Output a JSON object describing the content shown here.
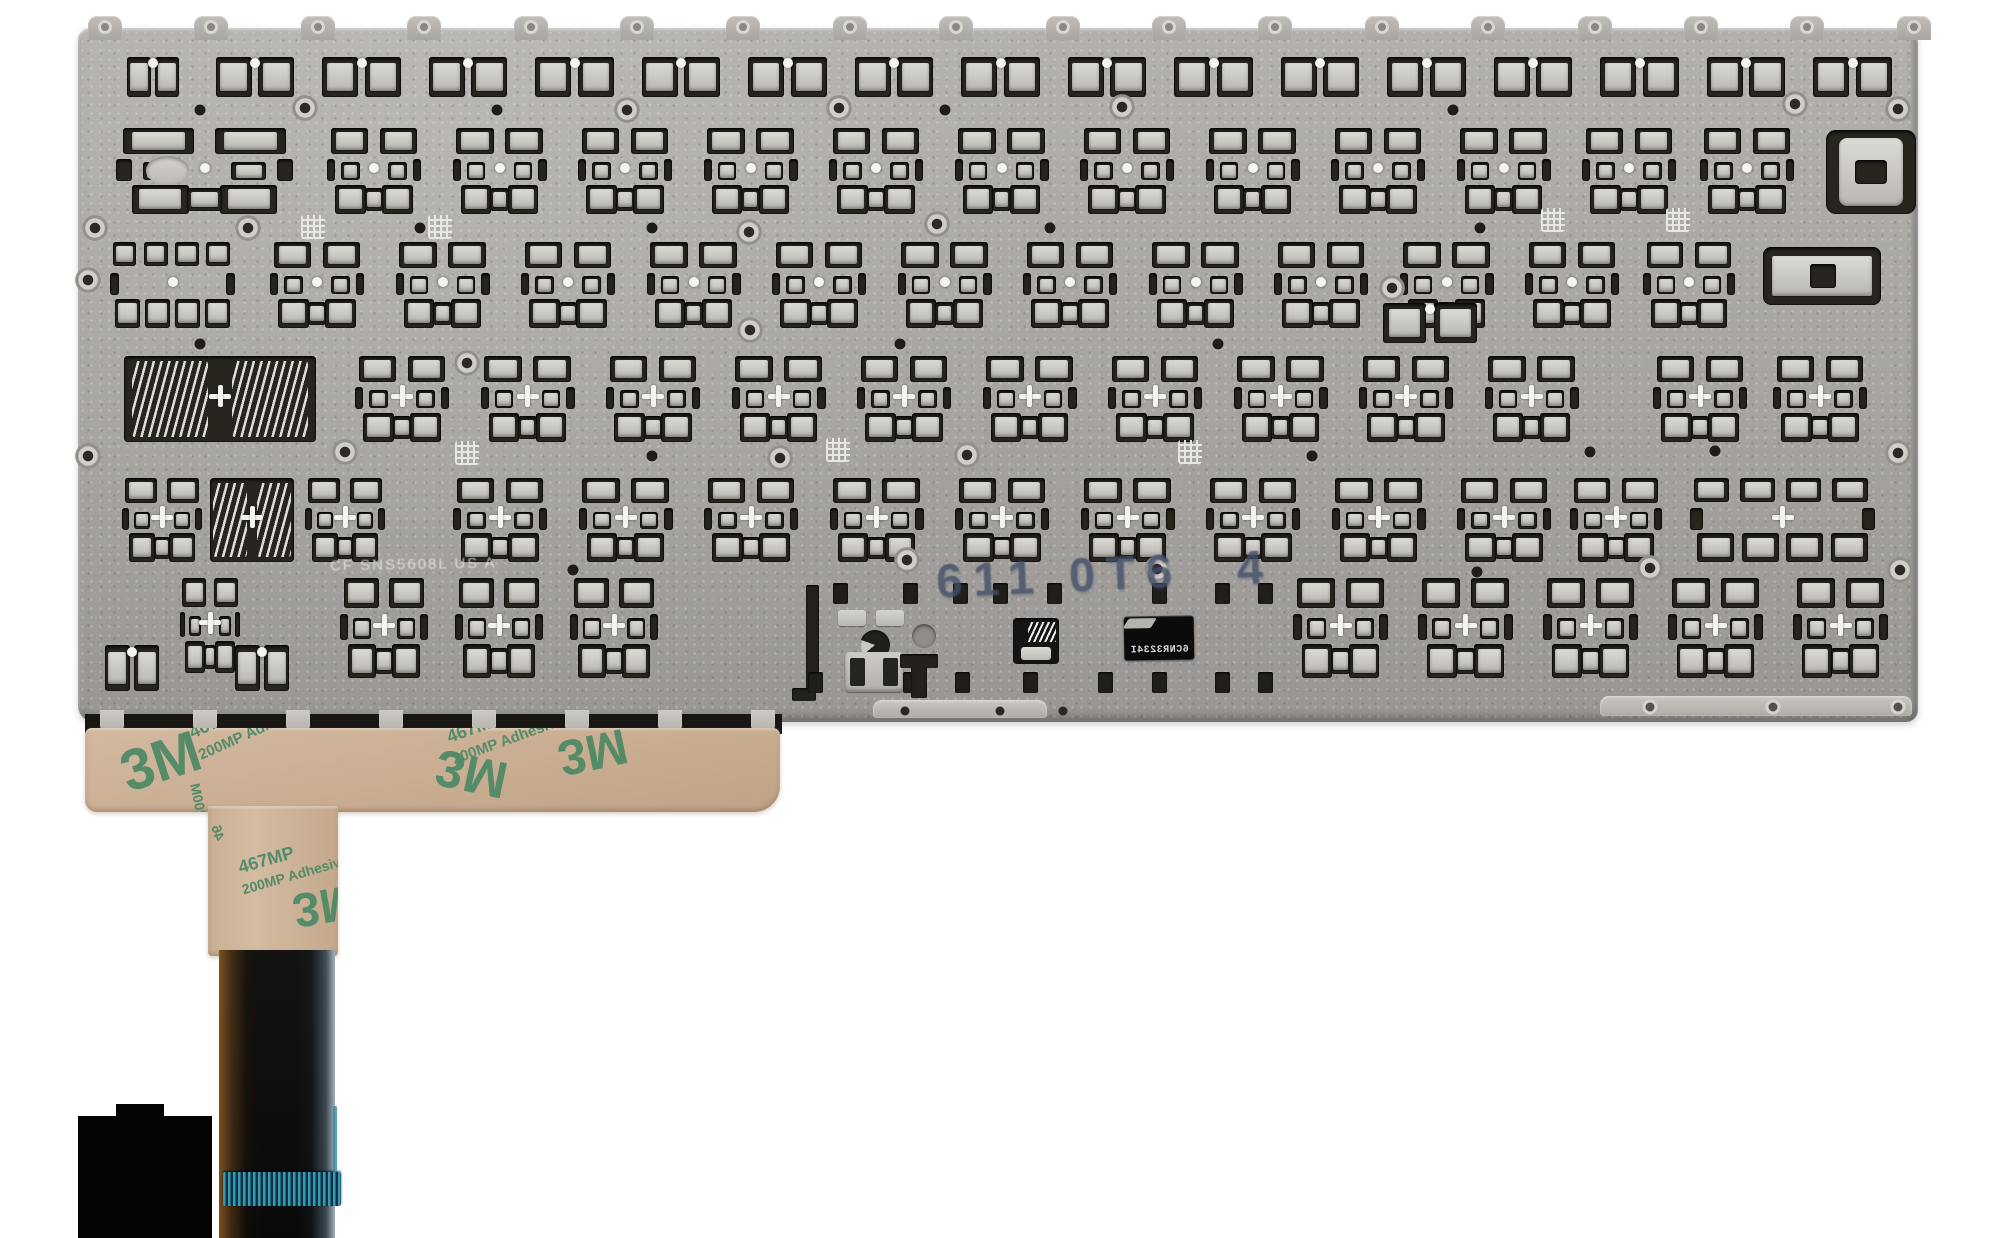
{
  "scene": {
    "title": "Laptop keyboard metal backplate, rear view with ribbon cable",
    "background": "#ffffff",
    "colors": {
      "plate": "#a8a5a1",
      "plate_edge": "#8e8b87",
      "cutout": "#28251f",
      "cutout_light": "#d7d5d0",
      "tape": "#cab095",
      "tape_print_green": "#4e8a66",
      "ribbon_black": "#100f0e",
      "connector_teal": "#3a98b4",
      "stamp_ink": "#42506b",
      "white_hole": "#f5f4f1"
    }
  },
  "plate": {
    "x": 78,
    "y": 28,
    "w": 1840,
    "h": 694,
    "top_tabs": {
      "count": 18,
      "x0": 88,
      "pitch": 106.4,
      "w": 34,
      "h": 24,
      "y": 16
    },
    "rows": [
      {
        "v": "clip",
        "y": 54,
        "h": 46,
        "xs": [
          125
        ],
        "w": 56,
        "c": "dot"
      },
      {
        "v": "clip",
        "y": 54,
        "h": 46,
        "x0": 213,
        "pitch": 106.5,
        "count": 16,
        "w": 84,
        "c": "dot"
      },
      {
        "v": "wide",
        "y": 128,
        "h": 86,
        "xs": [
          116
        ],
        "w": 177,
        "c": "dot"
      },
      {
        "v": "std",
        "y": 128,
        "h": 86,
        "x0": 327,
        "pitch": 125.5,
        "count": 11,
        "w": 94,
        "c": "dot"
      },
      {
        "v": "std",
        "y": 128,
        "h": 86,
        "xs": [
          1700
        ],
        "w": 94,
        "c": "dot"
      },
      {
        "v": "bracket",
        "y": 130,
        "h": 84,
        "xs": [
          1826
        ],
        "w": 90,
        "c": "dot"
      },
      {
        "v": "double",
        "y": 242,
        "h": 86,
        "xs": [
          110
        ],
        "w": 125,
        "c": "dot"
      },
      {
        "v": "std",
        "y": 242,
        "h": 86,
        "x0": 270,
        "pitch": 125.5,
        "count": 11,
        "w": 94,
        "c": "dot"
      },
      {
        "v": "std",
        "y": 242,
        "h": 86,
        "xs": [
          1643
        ],
        "w": 92,
        "c": "dot"
      },
      {
        "v": "bracketWide",
        "y": 247,
        "h": 58,
        "xs": [
          1763
        ],
        "w": 118,
        "c": "dot"
      },
      {
        "v": "trace",
        "y": 356,
        "h": 86,
        "xs": [
          120
        ],
        "w": 200,
        "c": "cross"
      },
      {
        "v": "std",
        "y": 356,
        "h": 86,
        "x0": 355,
        "pitch": 125.5,
        "count": 10,
        "w": 94,
        "c": "cross"
      },
      {
        "v": "std",
        "y": 356,
        "h": 86,
        "xs": [
          1653,
          1773
        ],
        "w": 94,
        "c": "cross"
      },
      {
        "v": "clip",
        "y": 300,
        "h": 46,
        "xs": [
          1380
        ],
        "w": 100,
        "c": "dot"
      },
      {
        "v": "std",
        "y": 478,
        "h": 84,
        "xs": [
          122
        ],
        "w": 80,
        "c": "cross"
      },
      {
        "v": "trace",
        "y": 478,
        "h": 84,
        "xs": [
          208
        ],
        "w": 88,
        "c": "cross"
      },
      {
        "v": "std",
        "y": 478,
        "h": 84,
        "xs": [
          305
        ],
        "w": 80,
        "c": "cross"
      },
      {
        "v": "std",
        "y": 478,
        "h": 84,
        "x0": 453,
        "pitch": 125.5,
        "count": 9,
        "w": 94,
        "c": "cross"
      },
      {
        "v": "std",
        "y": 478,
        "h": 84,
        "xs": [
          1570
        ],
        "w": 92,
        "c": "cross"
      },
      {
        "v": "double",
        "y": 478,
        "h": 84,
        "xs": [
          1690
        ],
        "w": 185,
        "c": "cross"
      },
      {
        "v": "std",
        "y": 578,
        "h": 95,
        "xs": [
          180
        ],
        "w": 60,
        "c": "cross"
      },
      {
        "v": "std",
        "y": 578,
        "h": 100,
        "x0": 340,
        "pitch": 115,
        "count": 3,
        "w": 88,
        "c": "cross"
      },
      {
        "v": "std",
        "y": 578,
        "h": 100,
        "x0": 1293,
        "pitch": 125,
        "count": 5,
        "w": 95,
        "c": "cross"
      },
      {
        "v": "clip",
        "y": 642,
        "h": 52,
        "xs": [
          103,
          233
        ],
        "w": 58,
        "c": "dot"
      }
    ],
    "screws": [
      [
        305,
        108
      ],
      [
        627,
        110
      ],
      [
        839,
        108
      ],
      [
        1122,
        107
      ],
      [
        1795,
        104
      ],
      [
        1898,
        109
      ],
      [
        95,
        228
      ],
      [
        248,
        228
      ],
      [
        749,
        232
      ],
      [
        937,
        224
      ],
      [
        88,
        280
      ],
      [
        750,
        330
      ],
      [
        467,
        363
      ],
      [
        88,
        456
      ],
      [
        345,
        452
      ],
      [
        780,
        458
      ],
      [
        967,
        455
      ],
      [
        1898,
        453
      ],
      [
        907,
        560
      ],
      [
        1157,
        569
      ],
      [
        1650,
        568
      ],
      [
        1900,
        570
      ]
    ],
    "cross_screw": [
      1392,
      288
    ],
    "dots": [
      [
        200,
        110
      ],
      [
        497,
        110
      ],
      [
        945,
        110
      ],
      [
        1453,
        110
      ],
      [
        420,
        228
      ],
      [
        652,
        228
      ],
      [
        1050,
        228
      ],
      [
        1480,
        228
      ],
      [
        200,
        344
      ],
      [
        900,
        344
      ],
      [
        1218,
        344
      ],
      [
        652,
        456
      ],
      [
        1312,
        456
      ],
      [
        1590,
        452
      ],
      [
        1715,
        451
      ],
      [
        573,
        570
      ],
      [
        1477,
        572
      ]
    ],
    "vents": [
      [
        313,
        227
      ],
      [
        440,
        227
      ],
      [
        1553,
        220
      ],
      [
        1678,
        220
      ],
      [
        838,
        450
      ],
      [
        1190,
        452
      ],
      [
        467,
        453
      ]
    ],
    "bottom_bands": [
      {
        "x": 873,
        "y": 700,
        "w": 174,
        "h": 18,
        "holes": [
          905,
          1000,
          1063
        ]
      },
      {
        "x": 1600,
        "y": 696,
        "w": 312,
        "h": 20,
        "rings": [
          1650,
          1773,
          1898
        ]
      }
    ],
    "labels": {
      "plate_print": {
        "text": "CF SNS5608L US A"
      },
      "stamp": {
        "left": "611 0T6",
        "right": "4"
      },
      "sticker": {
        "text": "6CNR3234I",
        "note": "printed mirrored on label"
      }
    }
  },
  "spacebar_area": {
    "slot": {
      "x": 806,
      "y": 585,
      "w": 13,
      "h": 108
    },
    "slot_foot": {
      "x": 792,
      "y": 688,
      "w": 24,
      "h": 13
    },
    "squares_top": {
      "y": 583,
      "xs": [
        833,
        903,
        953,
        993,
        1047,
        1152,
        1215,
        1258
      ]
    },
    "squares_bottom": {
      "y": 672,
      "xs": [
        808,
        903,
        955,
        1023,
        1098,
        1152,
        1215,
        1258
      ]
    },
    "light_tabs": [
      [
        838,
        610
      ],
      [
        876,
        610
      ]
    ],
    "c_hole": {
      "x": 860,
      "y": 630,
      "d": 30
    },
    "gray_circle": {
      "x": 912,
      "y": 624,
      "d": 24
    },
    "trace_window": {
      "x": 1013,
      "y": 618,
      "w": 46,
      "h": 46
    },
    "h_cutout": {
      "x": 845,
      "y": 652,
      "w": 58,
      "h": 40
    },
    "t_cutout": {
      "x": 900,
      "y": 654,
      "w": 38,
      "h": 44
    }
  },
  "bottom_strip": {
    "x": 85,
    "y": 714,
    "w": 697,
    "h": 20,
    "tabs": {
      "x0": 100,
      "pitch": 93,
      "count": 8,
      "w": 24,
      "h": 22,
      "y": 710
    }
  },
  "tape": {
    "wide": {
      "x": 85,
      "y": 728,
      "w": 695,
      "h": 84
    },
    "column": {
      "x": 208,
      "y": 806,
      "w": 130,
      "h": 150
    },
    "prints": [
      {
        "t": "3M",
        "x": 112,
        "y": 742,
        "rot": -18,
        "s": 58,
        "m": false
      },
      {
        "t": "467MP",
        "x": 186,
        "y": 724,
        "rot": -24,
        "s": 18,
        "m": false
      },
      {
        "t": "200MP Adhe",
        "x": 196,
        "y": 748,
        "rot": -24,
        "s": 15,
        "m": false
      },
      {
        "t": "3M",
        "x": 430,
        "y": 795,
        "rot": 192,
        "s": 52,
        "m": true
      },
      {
        "t": "467MP",
        "x": 444,
        "y": 728,
        "rot": -20,
        "s": 18,
        "m": false
      },
      {
        "t": "200MP Adhesive",
        "x": 450,
        "y": 752,
        "rot": -20,
        "s": 15,
        "m": false
      },
      {
        "t": "3M",
        "x": 565,
        "y": 788,
        "rot": 168,
        "s": 50,
        "m": true
      },
      {
        "t": "467MP",
        "x": 236,
        "y": 858,
        "rot": -16,
        "s": 18,
        "m": false
      },
      {
        "t": "200MP Adhesiv",
        "x": 240,
        "y": 882,
        "rot": -16,
        "s": 14,
        "m": false
      },
      {
        "t": "3M",
        "x": 298,
        "y": 938,
        "rot": 170,
        "s": 48,
        "m": true
      },
      {
        "t": "200M",
        "x": 210,
        "y": 816,
        "rot": 78,
        "s": 14,
        "m": true
      },
      {
        "t": "46",
        "x": 228,
        "y": 838,
        "rot": 74,
        "s": 14,
        "m": true
      }
    ]
  },
  "ribbon": {
    "x": 219,
    "y": 950,
    "w": 116,
    "h": 288,
    "connector": {
      "x": 223,
      "y": 1172,
      "w": 118,
      "h": 34
    },
    "edge_line": {
      "x": 333,
      "y": 1106,
      "w": 4,
      "h": 66
    }
  },
  "artifacts": {
    "black_block": {
      "x": 78,
      "y": 1116,
      "w": 134,
      "h": 122
    },
    "black_bump": {
      "x": 116,
      "y": 1104,
      "w": 48,
      "h": 14
    }
  }
}
